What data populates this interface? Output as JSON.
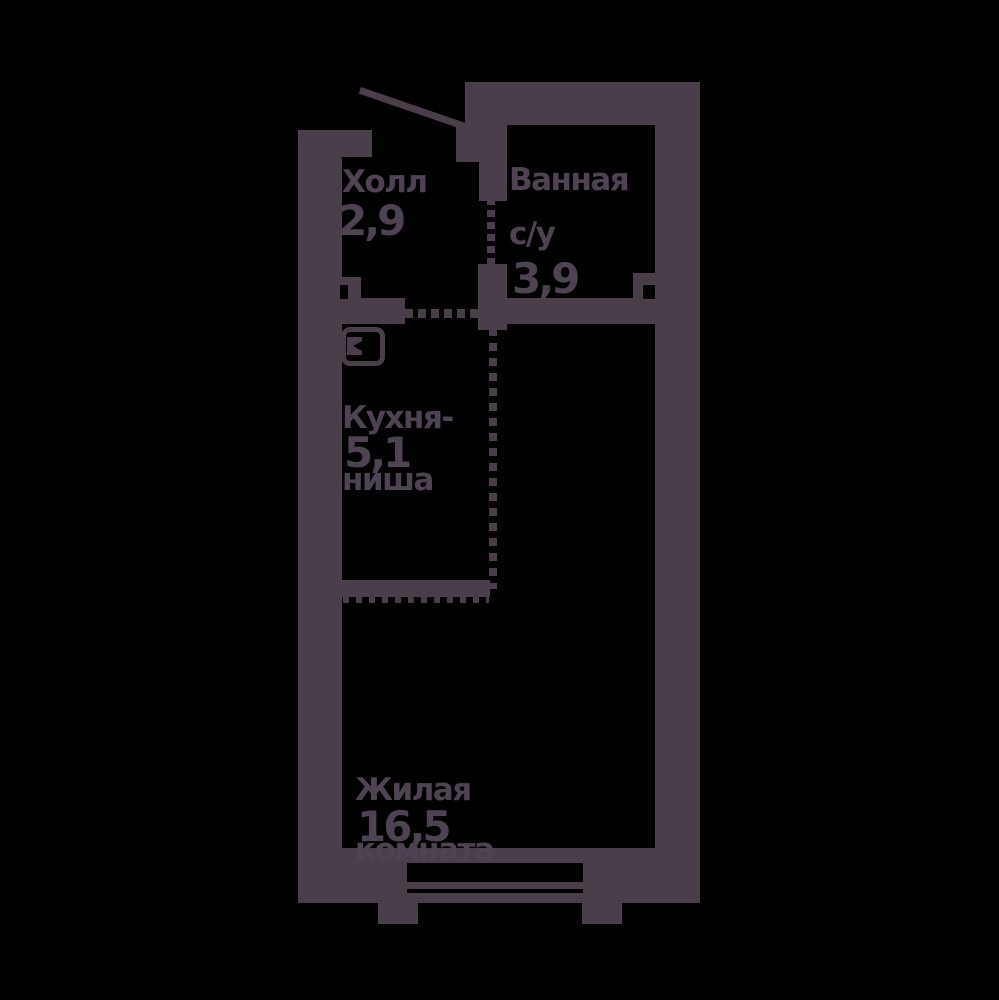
{
  "colors": {
    "background": "#000000",
    "wall": "#4a3e4b",
    "label": "#4f4252"
  },
  "rooms": {
    "hall": {
      "name": "Холл",
      "area": "2,9"
    },
    "bathroom": {
      "name_line1": "Ванная",
      "name_line2": "с/у",
      "area": "3,9"
    },
    "kitchen": {
      "name_line1": "Кухня-",
      "name_line2": "ниша",
      "area": "5,1"
    },
    "living": {
      "name_line1": "Жилая",
      "name_line2": "комната",
      "area": "16,5"
    }
  }
}
